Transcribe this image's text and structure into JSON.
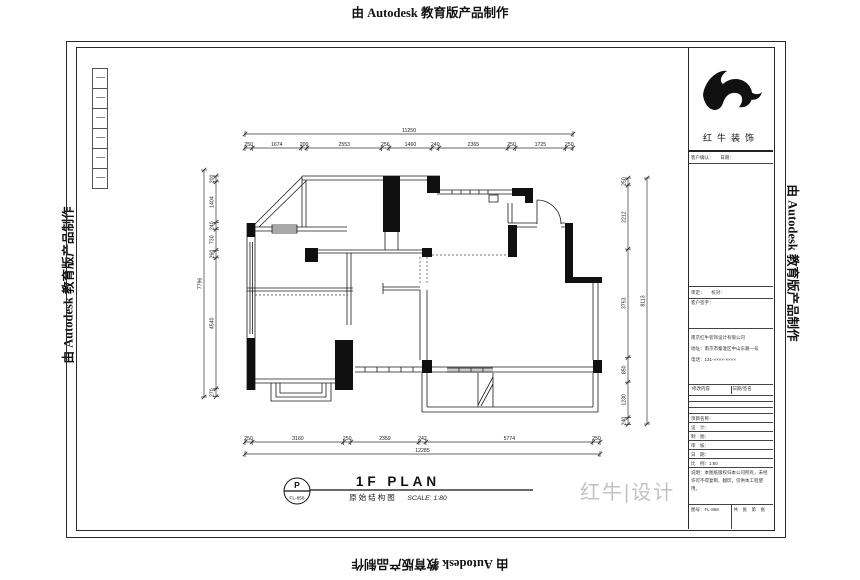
{
  "watermark": "由 Autodesk 教育版产品制作",
  "corner_mark": "红牛|设计",
  "plan_title": {
    "tag_top": "P",
    "tag_bottom": "FL-858",
    "en": "1F PLAN",
    "cn": "原始结构图",
    "scale": "SCALE: 1:80"
  },
  "dims": {
    "top_total": "11250",
    "top_segments": [
      "250",
      "1674",
      "200",
      "2553",
      "256",
      "1460",
      "240",
      "2365",
      "250",
      "1725",
      "250"
    ],
    "bottom_total": "12285",
    "bottom_segments": [
      "250",
      "3160",
      "250",
      "2359",
      "242",
      "5774",
      "250"
    ],
    "left_total": "7796",
    "left_segments": [
      "200",
      "1404",
      "240",
      "730",
      "260",
      "4540",
      "270"
    ],
    "right_total": "8113",
    "right_segments": [
      "250",
      "2212",
      "3753",
      "850",
      "1230",
      "240"
    ]
  },
  "titleblock": {
    "brand": "红牛装饰",
    "row1": "客户确认：　　日期：",
    "row2": "审定：　　校对：",
    "row3": "客户签字：",
    "company1": "南京红牛装饰设计有限公司",
    "company2": "地址：南京市秦淮区中山东路一号",
    "company3": "电话：131-××××-××××",
    "rev_left": "修改内容",
    "rev_right": "日期/签名",
    "f1": "项目名称：",
    "f2": "设　计：",
    "f3": "制　图：",
    "f4": "审　核：",
    "f5": "日　期：",
    "f6": "比　例：1:80",
    "note": "说明：本图纸版权归本公司所有，未经许可不得复制、翻印，仅供本工程使用。",
    "sheet_no": "图号：FL-858",
    "sheet_idx": "共　张　第　张"
  }
}
